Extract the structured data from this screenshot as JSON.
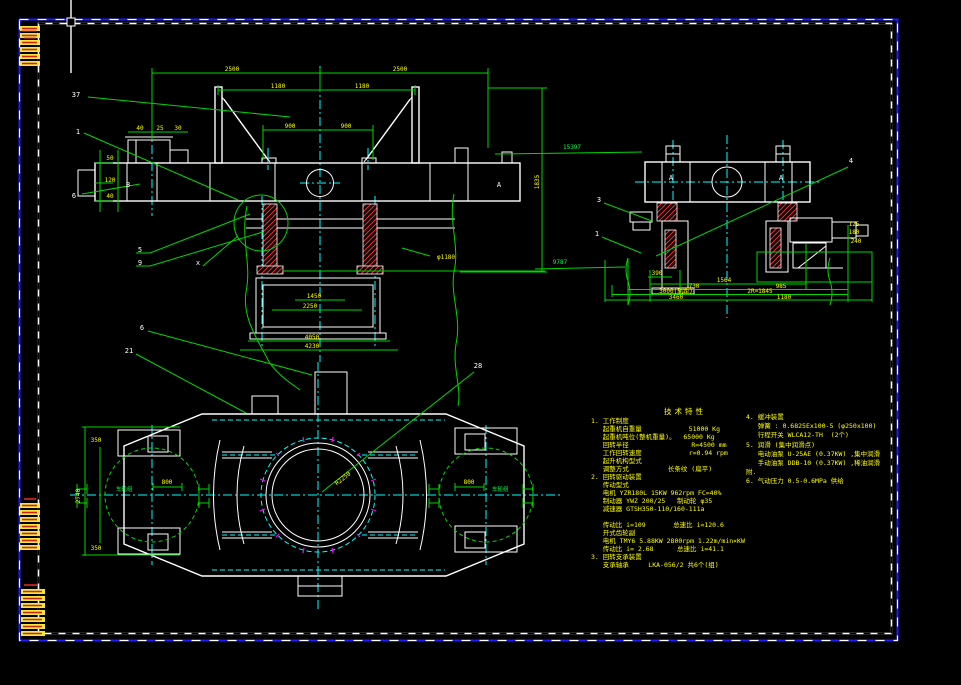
{
  "app": {
    "background": "#000000",
    "colors": {
      "structure": "#ffffff",
      "dimension_lines": "#00d800",
      "dimension_text": "#ffff00",
      "centerline": "#00ffff",
      "hatch": "#ff2a2a",
      "sheet_border": "#1d1dff",
      "bolt_ticks": "#ff00ff"
    }
  },
  "front": {
    "label_b": "B",
    "label_a": "A",
    "label_x": "x",
    "bal37": "37",
    "bal1": "1",
    "bal6": "6",
    "bal5": "5",
    "bal9": "9",
    "t1": "2500",
    "t2": "2500",
    "m1": "1180",
    "m2": "1180",
    "i1": "900",
    "i2": "900",
    "s1": "50",
    "s2": "120",
    "s3": "40",
    "b1": "40",
    "b2": "25",
    "b3": "30",
    "p1": "1450",
    "p2": "2250",
    "p3": "4050",
    "p4": "4230",
    "dv": "1835",
    "phi": "φ1180",
    "e1": "15397",
    "e2": "9787"
  },
  "side": {
    "a1": "A",
    "a2": "A",
    "bal3": "3",
    "bal1": "1",
    "bal4": "4",
    "r0": "390",
    "r1": "1564",
    "r2a": "730",
    "r2b": "985",
    "r3a": "3000(轨距)",
    "r3b": "2R=1845",
    "r4a": "3460",
    "r4b": "1180",
    "m1": "125",
    "m2": "180",
    "m3": "240"
  },
  "plan": {
    "bal6": "6",
    "bal21": "21",
    "bal28": "28",
    "wheel_l": "车轮组",
    "wheel_r": "车轮组",
    "dw1": "800",
    "dw2": "800",
    "radius": "R2250",
    "dl1": "350",
    "dl2": "350",
    "dl3": "2740"
  },
  "spec": {
    "title": "技术特性",
    "left": [
      "1. 工作制度",
      "   起重机自重量            51000 Kg",
      "   起重机吨位(整机重量)。  65000 Kg",
      "   回转半径                R=4500 mm",
      "   工作回转速度            r=0.94 rpm",
      "   起升机构型式",
      "   调整方式          长条纹 (扁平)",
      "2. 回转驱动装置",
      "   传动型式",
      "   电机 YZR180L 15KW 962rpm FC=40%",
      "   制动器 YWZ 200/25   制动轮 φ35",
      "   减速器 GTSH350-110/160-111a",
      "",
      "   传动比 i=109       总速比 i=120.6",
      "   开式齿轮副",
      "   电机 TMY6 5.88KW 2800rpm 1.22m/min×KW",
      "   传动比 i= 2.68      总速比 i=41.1",
      "3. 回转支承装置",
      "   支承轴承     LKA-056/2 共6个(组)"
    ],
    "right": [
      "4. 缓冲装置",
      "   弹簧 : 0.6825Ex100-5 (φ250x100)",
      "   行程开关 WLCA12-TH  (2个)",
      "5. 润滑 (集中润滑点)",
      "   电动油泵 U-25AE (0.37KW) ,集中润滑",
      "   手动油泵 DDB-10 (0.37KW) ,稀油润滑",
      "附.",
      "6. 气动压力 0.5-0.6MPa 供给"
    ]
  }
}
